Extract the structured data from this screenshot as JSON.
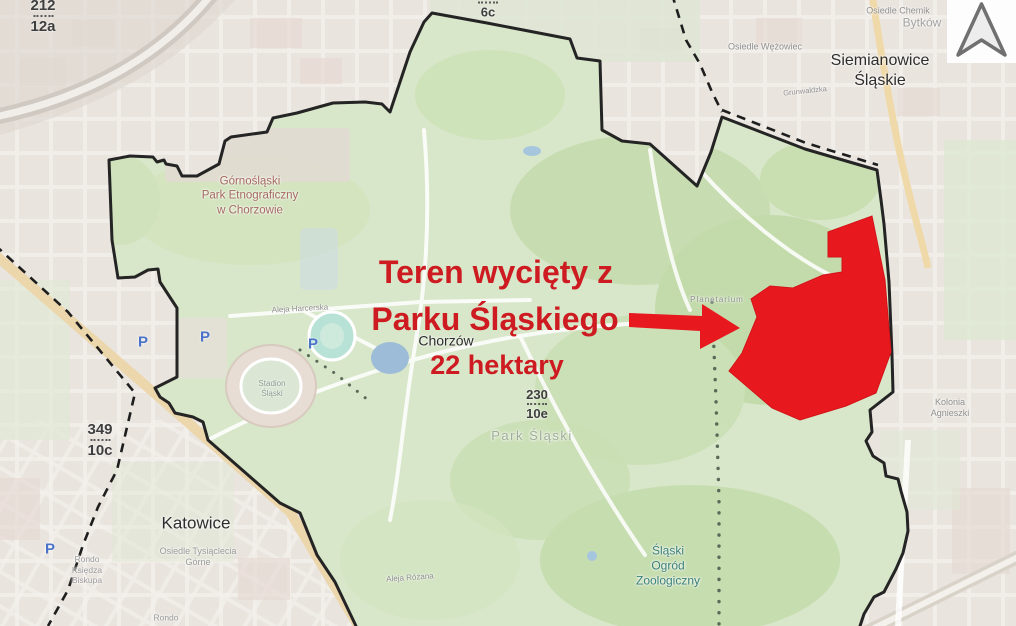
{
  "colors": {
    "annotation_red": "#cd1b21",
    "cut_area_red": "#e8191e",
    "park_green": "#d8e6c9",
    "boundary_black": "#242424",
    "water_blue": "#9dbcd8"
  },
  "annotation": {
    "line1": "Teren wycięty z",
    "line2": "Parku Śląskiego",
    "area": "22 hektary"
  },
  "cities": {
    "katowice": "Katowice",
    "chorzow": "Chorzów",
    "siemianowice": "Siemianowice Śląskie"
  },
  "districts": {
    "wezowiec": "Osiedle Wężowiec",
    "chemik": "Osiedle Chemik",
    "bytkow": "Bytków",
    "grunwaldzka": "Grunwaldzka",
    "tysiaclecia": "Osiedle Tysiąclecia\nGórne",
    "kolonia": "Kolonia Agnieszki",
    "rondo_ksiedza": "Rondo\nKsiędza\nBiskupa",
    "rondo": "Rondo"
  },
  "parks": {
    "etnograficzny": "Górnośląski\nPark Etnograficzny\nw Chorzowie",
    "park_slaski": "Park Śląski",
    "zoo": "Śląski\nOgród\nZoologiczny",
    "stadion": "Stadion\nŚląski"
  },
  "streets": {
    "aleja_harcerska": "Aleja Harcerska",
    "aleja_rozana": "Aleja Różana",
    "planetarium": "Planetarium"
  },
  "road_shields": {
    "s1_top": "212",
    "s1_bottom": "12a",
    "s2_top": "349",
    "s2_bottom": "10c",
    "s3_top": "230",
    "s3_bottom": "10e",
    "s4_bottom": "6c"
  },
  "icons": {
    "parking": "P"
  }
}
